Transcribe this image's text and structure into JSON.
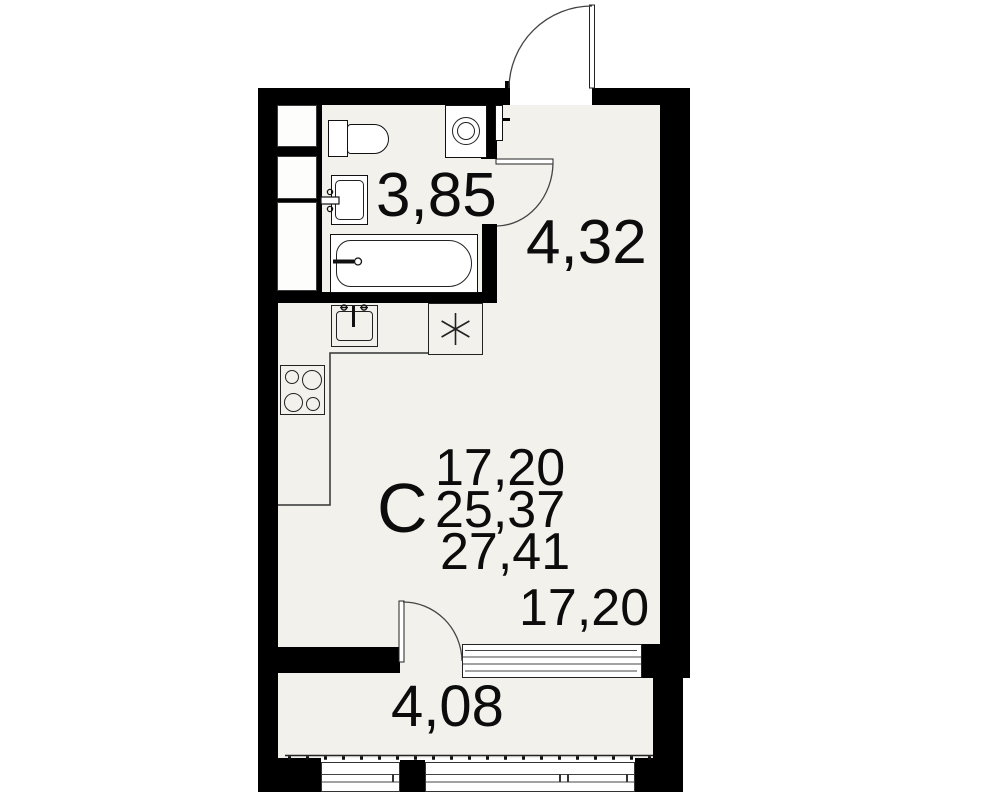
{
  "title_letter": "С",
  "areas": {
    "stack": [
      "17,20",
      "25,37",
      "27,41"
    ],
    "bathroom": "3,85",
    "hallway": "4,32",
    "living": "17,20",
    "balcony": "4,08"
  },
  "colors": {
    "wall": "#000000",
    "floor": "#f2f1ec",
    "line": "#333333",
    "background": "#ffffff"
  },
  "fixtures": [
    "toilet",
    "washbasin",
    "bathtub",
    "washing-machine",
    "ventilation-shafts",
    "entry-door",
    "bathroom-door",
    "kitchen-sink",
    "stove",
    "appliance-niche-asterisk",
    "balcony-door",
    "window",
    "balcony-glazing"
  ]
}
